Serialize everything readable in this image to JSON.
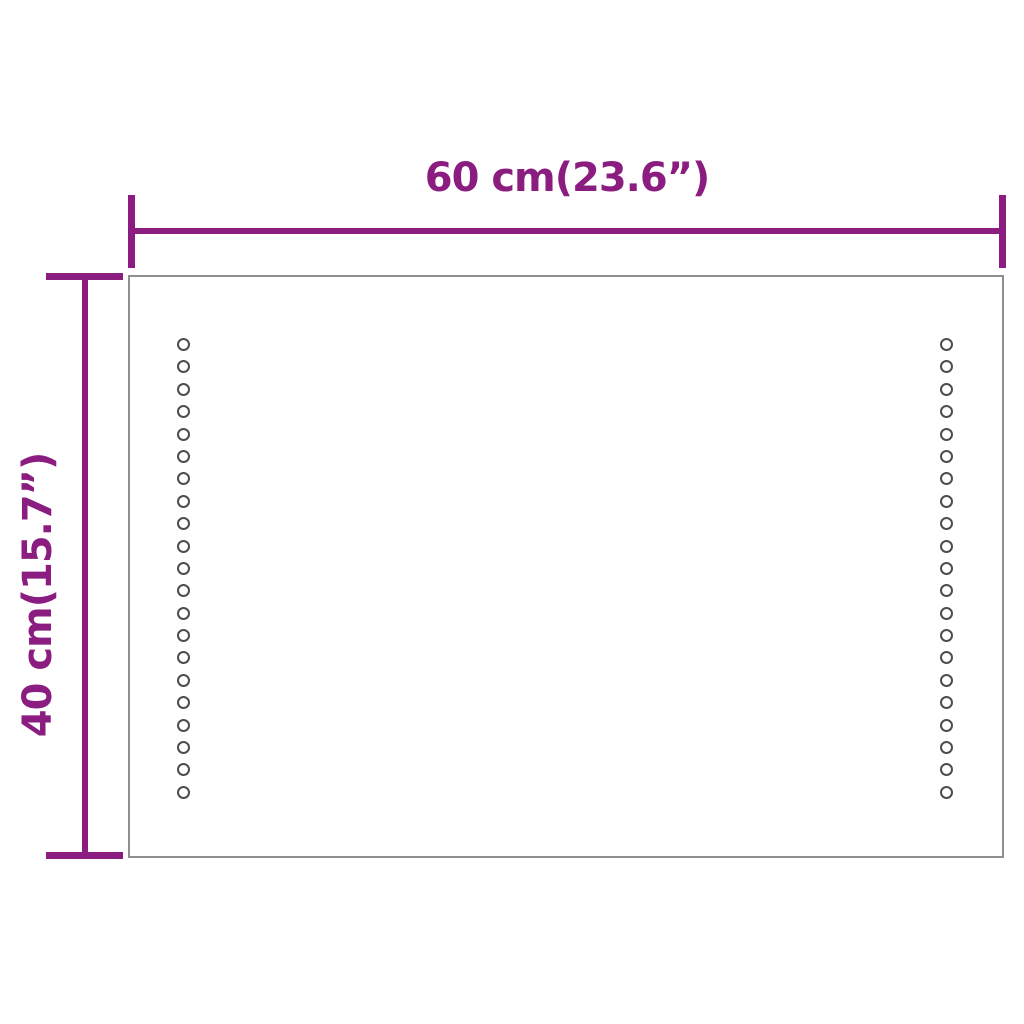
{
  "diagram": {
    "type": "product-dimension-diagram",
    "subject": "rectangular LED mirror panel",
    "width_label": "60 cm(23.6”)",
    "height_label": "40 cm(15.7”)",
    "led_columns": 2,
    "led_dots_per_column": 21,
    "colors": {
      "dimension_accent": "#8a1d7f",
      "panel_border": "#8f8f8f",
      "led_dot_outline": "#4d4d4d",
      "background": "#ffffff"
    }
  }
}
